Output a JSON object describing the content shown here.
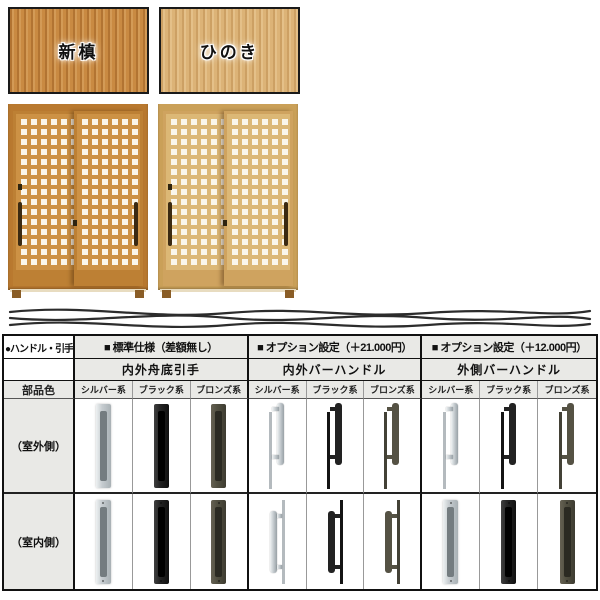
{
  "swatches": [
    {
      "label": "新槙"
    },
    {
      "label": "ひのき"
    }
  ],
  "table": {
    "corner_label": "●ハンドル・引手",
    "part_color_label": "部品色",
    "groups": [
      {
        "spec": "■ 標準仕様（差額無し）",
        "name": "内外舟底引手"
      },
      {
        "spec": "■ オプション設定（＋21.000円）",
        "name": "内外バーハンドル"
      },
      {
        "spec": "■ オプション設定（＋12.000円）",
        "name": "外側バーハンドル"
      }
    ],
    "color_labels": [
      "シルバー系",
      "ブラック系",
      "ブロンズ系"
    ],
    "rows": [
      {
        "label": "（室外側）",
        "cells": [
          {
            "handle": "recessed-pull",
            "finish": "silver"
          },
          {
            "handle": "recessed-pull",
            "finish": "black"
          },
          {
            "handle": "recessed-pull",
            "finish": "bronze"
          },
          {
            "handle": "bar-handle",
            "finish": "silver"
          },
          {
            "handle": "bar-handle",
            "finish": "black"
          },
          {
            "handle": "bar-handle",
            "finish": "bronze"
          },
          {
            "handle": "bar-handle",
            "finish": "silver"
          },
          {
            "handle": "bar-handle",
            "finish": "black"
          },
          {
            "handle": "bar-handle",
            "finish": "bronze"
          }
        ]
      },
      {
        "label": "（室内側）",
        "cells": [
          {
            "handle": "recessed-pull",
            "finish": "silver"
          },
          {
            "handle": "recessed-pull",
            "finish": "black"
          },
          {
            "handle": "recessed-pull",
            "finish": "bronze"
          },
          {
            "handle": "bar-handle",
            "finish": "silver"
          },
          {
            "handle": "bar-handle",
            "finish": "black"
          },
          {
            "handle": "bar-handle",
            "finish": "bronze"
          },
          {
            "handle": "recessed-pull",
            "finish": "silver"
          },
          {
            "handle": "recessed-pull",
            "finish": "black"
          },
          {
            "handle": "recessed-pull",
            "finish": "bronze"
          }
        ]
      }
    ]
  },
  "colors": {
    "wood_shinmaki": "#c98a42",
    "wood_hinoki": "#dcb377",
    "finish_silver": "#c6ccd0",
    "finish_black": "#242424",
    "finish_bronze": "#514f41",
    "table_header_bg": "#e9e9e6"
  }
}
